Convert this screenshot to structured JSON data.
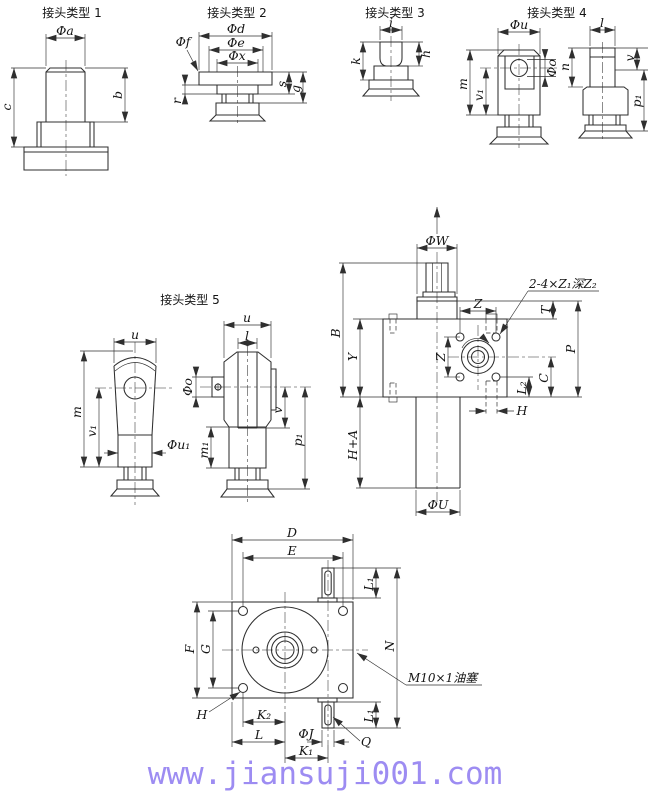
{
  "colors": {
    "line": "#2f2f2f",
    "ink": "#141414",
    "watermark": "#9d8cf2",
    "background": "#ffffff"
  },
  "joints": {
    "j1": {
      "title": "接头类型 1",
      "phi_a": "Φa",
      "b": "b",
      "c": "c"
    },
    "j2": {
      "title": "接头类型 2",
      "phi_d": "Φd",
      "phi_e": "Φe",
      "phi_x": "Φx",
      "phi_f": "Φf",
      "r": "r",
      "s": "s",
      "g": "g"
    },
    "j3": {
      "title": "接头类型 3",
      "i": "i",
      "k": "k",
      "h": "h"
    },
    "j4": {
      "title": "接头类型 4",
      "phi_u": "Φu",
      "m": "m",
      "v1": "v₁",
      "phi_o": "Φo",
      "l": "l",
      "n": "n",
      "v": "v",
      "p1": "p₁"
    },
    "j5": {
      "title": "接头类型 5",
      "u_left": "u",
      "m": "m",
      "v1": "v₁",
      "phi_u1": "Φu₁",
      "u_right": "u",
      "l": "l",
      "phi_o": "Φo",
      "m1": "m₁",
      "v": "v",
      "p1": "p₁"
    }
  },
  "main_view": {
    "phi_w": "ΦW",
    "note": "2-4×Z₁深Z₂",
    "z_top": "Z",
    "z_side": "Z",
    "t": "T",
    "b": "B",
    "y": "Y",
    "p": "P",
    "l2": "L₂",
    "c": "C",
    "h": "H",
    "h_plus_a": "H+A",
    "phi_u": "ΦU"
  },
  "bottom_view": {
    "d": "D",
    "e": "E",
    "l1_top": "L₁",
    "n": "N",
    "f": "F",
    "g": "G",
    "oil_plug": "M10×1油塞",
    "h": "H",
    "k2": "K₂",
    "l": "L",
    "phi_j": "ΦJ",
    "k1": "K₁",
    "l1_bottom": "L₁",
    "q": "Q"
  },
  "watermark": {
    "text": "www.jiansuji001.com"
  }
}
